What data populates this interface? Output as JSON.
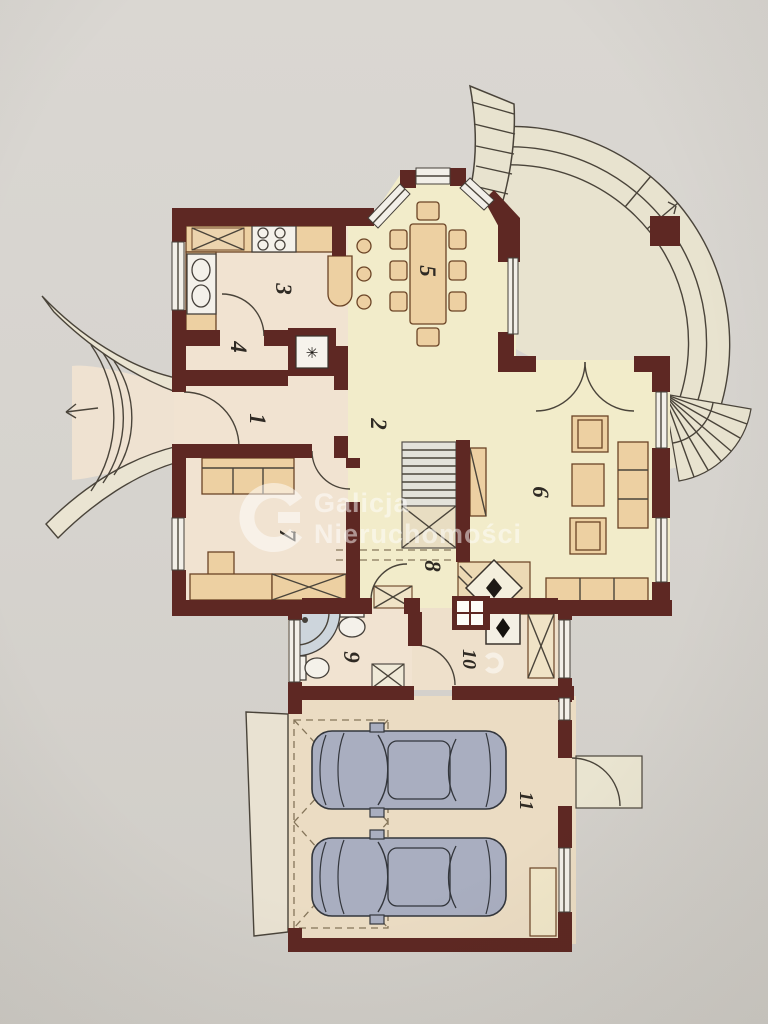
{
  "watermark": {
    "line1": "Galicja",
    "line2": "Nieruchomości"
  },
  "rooms": [
    {
      "number": "1"
    },
    {
      "number": "2"
    },
    {
      "number": "3"
    },
    {
      "number": "4"
    },
    {
      "number": "5"
    },
    {
      "number": "6"
    },
    {
      "number": "7"
    },
    {
      "number": "8"
    },
    {
      "number": "9"
    },
    {
      "number": "10"
    },
    {
      "number": "11"
    }
  ],
  "symbols": {
    "ventilation": "✳"
  },
  "colors": {
    "paper": "#d7d4cf",
    "wall": "#5e2823",
    "room_warm": "#f1e3d1",
    "room_cream": "#f2ecca",
    "garage_floor": "#ebdcc3",
    "terrace": "#e8e3cf",
    "furniture": "#edd0a2",
    "car_body": "#a9aec0",
    "shower": "#cdd5dc",
    "watermark": "#ffffff",
    "line": "#4a443a"
  }
}
